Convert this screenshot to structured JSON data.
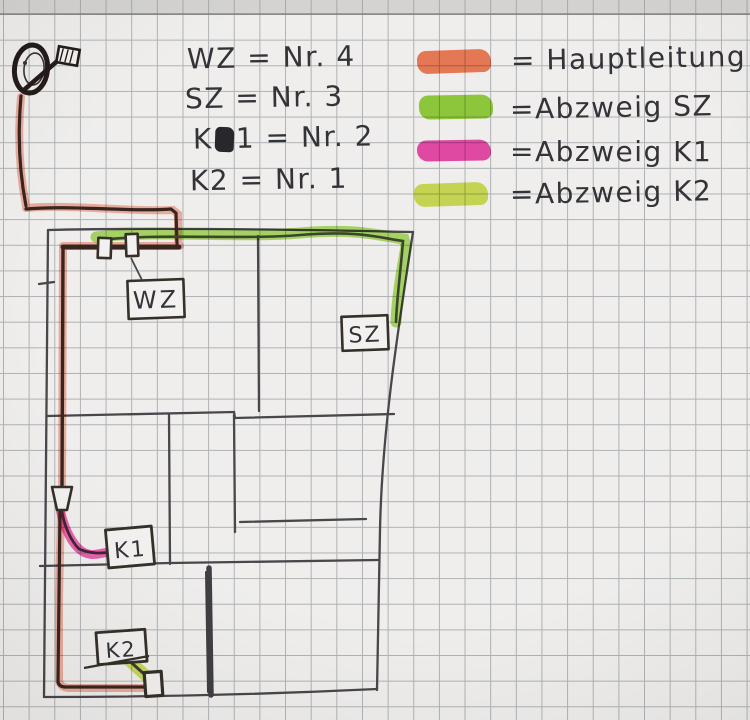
{
  "colors": {
    "paper": "#efeeec",
    "gridline": "#aeb2b5",
    "pencil": "#47474c",
    "ink": "#333338",
    "main_glow": "#f2907b",
    "main_core": "#3a241f",
    "sz_glow": "#8fd12e",
    "sz_core": "#3a452a",
    "k1_glow": "#ee3fa8",
    "k1_core": "#45232f",
    "k2_glow": "#cfe04a",
    "k2_core": "#3c3c2e",
    "box_stroke": "#353029",
    "box_fill": "#f2f1ef"
  },
  "key_list": {
    "items": [
      {
        "text": "WZ = Nr. 4"
      },
      {
        "text": "SZ = Nr. 3"
      },
      {
        "pre": "K",
        "post": "1 = Nr. 2"
      },
      {
        "text": "K2 = Nr. 1"
      }
    ]
  },
  "legend": {
    "items": [
      {
        "label": "= Hauptleitung",
        "color": "#f4764d"
      },
      {
        "label": "=Abzweig SZ",
        "color": "#8fd12e"
      },
      {
        "label": "=Abzweig K1",
        "color": "#ee3fa8"
      },
      {
        "label": "=Abzweig K2",
        "color": "#cfe04a"
      }
    ]
  },
  "plan": {
    "room_labels": {
      "wz": "WZ",
      "sz": "SZ",
      "k1": "K1",
      "k2": "K2"
    }
  }
}
